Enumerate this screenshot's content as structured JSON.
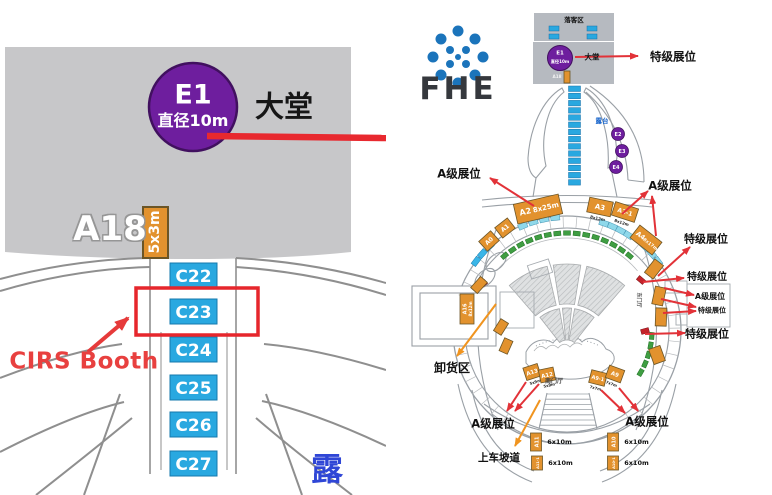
{
  "colors": {
    "lobby_gray_left": "#c7c7c9",
    "lobby_gray_right": "#b6bac0",
    "purple": "#6e1e9e",
    "purple_stroke": "#41105f",
    "booth_blue": "#29a8e0",
    "booth_orange": "#e2922e",
    "booth_green": "#3f9e42",
    "booth_cyan": "#8fd8ea",
    "booth_red": "#c4242b",
    "annot_red": "#e23238",
    "annot_orange": "#f0941f",
    "logo_blue": "#1b74bb",
    "wall_gray": "#9aa0a6"
  },
  "left": {
    "e1_label": "E1",
    "e1_sub": "直径10m",
    "hall": "大堂",
    "a18": "A18",
    "booth_5x3": "5x3m",
    "cirs": "CIRS Booth",
    "corner": "露",
    "c_booths": [
      {
        "label": "C22",
        "y": 263
      },
      {
        "label": "C23",
        "y": 299
      },
      {
        "label": "C24",
        "y": 337
      },
      {
        "label": "C25",
        "y": 375
      },
      {
        "label": "C26",
        "y": 412
      },
      {
        "label": "C27",
        "y": 451
      }
    ]
  },
  "right": {
    "logo": "FHE",
    "logo_dots": [
      {
        "x": 72,
        "y": 31,
        "r": 5.5
      },
      {
        "x": 89,
        "y": 39,
        "r": 5.5
      },
      {
        "x": 97,
        "y": 57,
        "r": 5.5
      },
      {
        "x": 89,
        "y": 75,
        "r": 5.5
      },
      {
        "x": 72,
        "y": 83,
        "r": 5.5
      },
      {
        "x": 55,
        "y": 75,
        "r": 5.5
      },
      {
        "x": 47,
        "y": 57,
        "r": 5.5
      },
      {
        "x": 55,
        "y": 39,
        "r": 5.5
      },
      {
        "x": 64,
        "y": 50,
        "r": 4
      },
      {
        "x": 80,
        "y": 50,
        "r": 4
      },
      {
        "x": 80,
        "y": 64,
        "r": 4
      },
      {
        "x": 64,
        "y": 64,
        "r": 4
      },
      {
        "x": 72,
        "y": 57,
        "r": 3
      }
    ],
    "dropoff_booths": [
      {
        "x": 163,
        "y": 26
      },
      {
        "x": 163,
        "y": 34
      },
      {
        "x": 201,
        "y": 26
      },
      {
        "x": 201,
        "y": 34
      }
    ],
    "c_column": {
      "x": 182.5,
      "y0": 86,
      "pitch": 7.2,
      "n": 14,
      "w": 12,
      "h": 5.5
    },
    "e_circles": [
      {
        "label": "E2",
        "cx": 232,
        "cy": 134
      },
      {
        "label": "E3",
        "cx": 236,
        "cy": 151
      },
      {
        "label": "E4",
        "cx": 230,
        "cy": 167
      }
    ],
    "seating": {
      "cx": 181,
      "cy": 352,
      "rows": [
        {
          "r1": 48,
          "r2": 88,
          "segs": [
            [
              -131,
              -103
            ],
            [
              -99,
              -81
            ],
            [
              -77,
              -49
            ]
          ]
        },
        {
          "r1": 12,
          "r2": 44,
          "segs": [
            [
              -128,
              -100
            ],
            [
              -96,
              -84
            ],
            [
              -80,
              -52
            ]
          ]
        }
      ]
    },
    "booth_arcs": [
      {
        "color": "#3f9e42",
        "stroke": "#1e6e22",
        "r": 97,
        "a1": -130,
        "a2": -50,
        "n": 15,
        "w": 7,
        "h": 4.5
      },
      {
        "color": "#3f9e42",
        "stroke": "#1e6e22",
        "r": 85,
        "a1": 4,
        "a2": 30,
        "n": 5,
        "w": 7,
        "h": 4.5
      },
      {
        "color": "#8fd8ea",
        "stroke": "#4596b4",
        "r": 113,
        "a1": -113,
        "a2": -96,
        "n": 4,
        "w": 9,
        "h": 5.5
      },
      {
        "color": "#8fd8ea",
        "stroke": "#4596b4",
        "r": 113,
        "a1": -71,
        "a2": -57,
        "n": 4,
        "w": 9,
        "h": 5.5
      },
      {
        "color": "#8fd8ea",
        "stroke": "#4596b4",
        "r": 114,
        "a1": -47,
        "a2": -37,
        "n": 3,
        "w": 9,
        "h": 5.5
      },
      {
        "color": "#3ab6e8",
        "stroke": "#1a7fb0",
        "r": 114,
        "a1": -143,
        "a2": -133,
        "n": 3,
        "w": 9,
        "h": 5.5
      }
    ],
    "red_booths": [
      {
        "x": 255,
        "y": 280,
        "rot": 40
      },
      {
        "x": 259,
        "y": 331,
        "rot": -15
      },
      {
        "x": 97,
        "y": 284,
        "rot": -40
      }
    ],
    "inner_rooms": [
      {
        "x": 114,
        "y": 292,
        "w": 34,
        "h": 36,
        "rot": 0
      },
      {
        "x": 143,
        "y": 262,
        "w": 22,
        "h": 14,
        "rot": -18
      },
      {
        "x": 279,
        "y": 281,
        "w": 22,
        "h": 12,
        "rot": 0
      },
      {
        "x": 301,
        "y": 284,
        "w": 43,
        "h": 43,
        "rot": 0
      },
      {
        "x": 290,
        "y": 314,
        "w": 11,
        "h": 11,
        "rot": 0
      }
    ],
    "orange_booths": [
      {
        "name": "booth-a2",
        "x": 152,
        "y": 209,
        "w": 46,
        "h": 20,
        "rot": -13,
        "labels": [
          {
            "t": "A2",
            "dx": -13,
            "dy": 2.5,
            "s": 8
          },
          {
            "t": "8x25m",
            "dx": 8,
            "dy": 2.5,
            "s": 7
          }
        ]
      },
      {
        "name": "booth-a3",
        "x": 214,
        "y": 207,
        "w": 24,
        "h": 15,
        "rot": 12,
        "labels": [
          {
            "t": "A3",
            "dx": 0,
            "dy": 2.5,
            "s": 7
          }
        ],
        "out": {
          "t": "8x12m",
          "s": 4
        }
      },
      {
        "name": "booth-a3-1",
        "x": 239,
        "y": 212,
        "w": 24,
        "h": 14,
        "rot": 18,
        "labels": [
          {
            "t": "A3-1",
            "dx": 0,
            "dy": 2,
            "s": 6
          }
        ],
        "out": {
          "t": "8x12m",
          "s": 4
        }
      },
      {
        "name": "booth-a4",
        "x": 260,
        "y": 240,
        "w": 28,
        "h": 16,
        "rot": 38,
        "labels": [
          {
            "t": "A4",
            "dx": -7,
            "dy": 2,
            "s": 6.5
          },
          {
            "t": "8x17m",
            "dx": 6,
            "dy": 2,
            "s": 4.5
          }
        ]
      },
      {
        "name": "booth-a1",
        "x": 119,
        "y": 228,
        "w": 16,
        "h": 13,
        "rot": -38,
        "labels": [
          {
            "t": "A1",
            "dx": 0,
            "dy": 2,
            "s": 6
          }
        ]
      },
      {
        "name": "booth-a0",
        "x": 103,
        "y": 241,
        "w": 16,
        "h": 13,
        "rot": -42,
        "labels": [
          {
            "t": "A0",
            "dx": 0,
            "dy": 2,
            "s": 6
          }
        ]
      },
      {
        "name": "booth-a16",
        "x": 81,
        "y": 309,
        "w": 14,
        "h": 30,
        "rot": 0,
        "labels": [
          {
            "t": "A16",
            "dx": -2.5,
            "dy": 0,
            "s": 5,
            "vert": true
          },
          {
            "t": "8x12m",
            "dx": 3.5,
            "dy": 0,
            "s": 4,
            "vert": true
          }
        ]
      },
      {
        "name": "booth-a15",
        "x": 93,
        "y": 285,
        "w": 15,
        "h": 9,
        "rot": -48,
        "labels": []
      },
      {
        "name": "booth-west-1",
        "x": 115,
        "y": 327,
        "w": 14,
        "h": 9,
        "rot": -58,
        "labels": []
      },
      {
        "name": "booth-west-2",
        "x": 120,
        "y": 346,
        "w": 14,
        "h": 9,
        "rot": -66,
        "labels": []
      },
      {
        "name": "booth-a13",
        "x": 146,
        "y": 372,
        "w": 15,
        "h": 13,
        "rot": -18,
        "labels": [
          {
            "t": "A13",
            "dx": 0,
            "dy": 2,
            "s": 5.5
          }
        ],
        "out": {
          "t": "5x9m",
          "s": 3.8
        }
      },
      {
        "name": "booth-a12",
        "x": 161,
        "y": 375,
        "w": 15,
        "h": 13,
        "rot": -12,
        "labels": [
          {
            "t": "A12",
            "dx": 0,
            "dy": 2,
            "s": 5.5
          }
        ],
        "out": {
          "t": "5x9m",
          "s": 3.8
        }
      },
      {
        "name": "booth-a9-1",
        "x": 212,
        "y": 378,
        "w": 16,
        "h": 13,
        "rot": 14,
        "labels": [
          {
            "t": "A9-1",
            "dx": 0,
            "dy": 2,
            "s": 5
          }
        ],
        "out": {
          "t": "7x7m",
          "s": 3.8
        }
      },
      {
        "name": "booth-a9",
        "x": 229,
        "y": 374,
        "w": 16,
        "h": 13,
        "rot": 20,
        "labels": [
          {
            "t": "A9",
            "dx": 0,
            "dy": 2,
            "s": 5.5
          }
        ],
        "out": {
          "t": "7x7m",
          "s": 3.8
        }
      },
      {
        "name": "booth-east-1",
        "x": 268,
        "y": 269,
        "w": 11,
        "h": 17,
        "rot": 38,
        "labels": []
      },
      {
        "name": "booth-east-2",
        "x": 273,
        "y": 296,
        "w": 11,
        "h": 18,
        "rot": 12,
        "labels": []
      },
      {
        "name": "booth-east-3",
        "x": 275,
        "y": 317,
        "w": 11,
        "h": 18,
        "rot": 2,
        "labels": []
      },
      {
        "name": "booth-east-4",
        "x": 271,
        "y": 355,
        "w": 12,
        "h": 16,
        "rot": -20,
        "labels": []
      },
      {
        "name": "booth-lobby-a18",
        "x": 181,
        "y": 77,
        "w": 6,
        "h": 12,
        "rot": 0,
        "labels": []
      },
      {
        "name": "legend-booth-a11",
        "x": 150,
        "y": 442,
        "w": 11,
        "h": 18,
        "rot": 0,
        "labels": [
          {
            "t": "A11",
            "dx": 0.5,
            "dy": 0,
            "s": 5,
            "vert": true
          }
        ],
        "right": {
          "t": "6x10m",
          "s": 6.5,
          "dx": 18
        }
      },
      {
        "name": "legend-booth-a11-1",
        "x": 151,
        "y": 463,
        "w": 11,
        "h": 14,
        "rot": 0,
        "labels": [
          {
            "t": "A11-1",
            "dx": 0.5,
            "dy": 0,
            "s": 3.6,
            "vert": true
          }
        ],
        "right": {
          "t": "6x10m",
          "s": 6.5,
          "dx": 18
        }
      },
      {
        "name": "legend-booth-a10",
        "x": 227,
        "y": 442,
        "w": 11,
        "h": 18,
        "rot": 0,
        "labels": [
          {
            "t": "A10",
            "dx": 0.5,
            "dy": 0,
            "s": 5,
            "vert": true
          }
        ],
        "right": {
          "t": "6x10m",
          "s": 6.5,
          "dx": 18
        }
      },
      {
        "name": "legend-booth-a10-1",
        "x": 227,
        "y": 463,
        "w": 11,
        "h": 14,
        "rot": 0,
        "labels": [
          {
            "t": "A10-1",
            "dx": 0.5,
            "dy": 0,
            "s": 3.6,
            "vert": true
          }
        ],
        "right": {
          "t": "6x10m",
          "s": 6.5,
          "dx": 18
        }
      }
    ],
    "labels": [
      {
        "name": "label-special-top",
        "t": "特级展位",
        "x": 287,
        "y": 57,
        "s": 11.5
      },
      {
        "name": "label-alevel-topleft",
        "t": "A级展位",
        "x": 73,
        "y": 174,
        "s": 11.5
      },
      {
        "name": "label-alevel-topright",
        "t": "A级展位",
        "x": 284,
        "y": 186,
        "s": 11.5
      },
      {
        "name": "label-special-2",
        "t": "特级展位",
        "x": 320,
        "y": 239,
        "s": 11
      },
      {
        "name": "label-special-3",
        "t": "特级展位",
        "x": 321,
        "y": 278,
        "s": 10
      },
      {
        "name": "label-alevel-right",
        "t": "A级展位",
        "x": 324,
        "y": 297,
        "s": 8
      },
      {
        "name": "label-special-4",
        "t": "特级展位",
        "x": 326,
        "y": 311,
        "s": 7
      },
      {
        "name": "label-special-5",
        "t": "特级展位",
        "x": 321,
        "y": 334,
        "s": 11
      },
      {
        "name": "label-unloading",
        "t": "卸货区",
        "x": 66,
        "y": 368,
        "s": 12
      },
      {
        "name": "label-alevel-bottomleft",
        "t": "A级展位",
        "x": 107,
        "y": 424,
        "s": 11.5
      },
      {
        "name": "label-alevel-bottomright",
        "t": "A级展位",
        "x": 261,
        "y": 422,
        "s": 11.5
      },
      {
        "name": "label-ramp",
        "t": "上车坡道",
        "x": 113,
        "y": 458,
        "s": 10.5
      },
      {
        "name": "label-south-hall",
        "t": "南门厅",
        "x": 168,
        "y": 382,
        "s": 6,
        "c": "#444",
        "w": 600
      },
      {
        "name": "label-east-hall",
        "t": "东门厅",
        "x": 252,
        "y": 300,
        "s": 5,
        "c": "#555",
        "rot": 90,
        "w": 600
      },
      {
        "name": "label-terrace",
        "t": "露台",
        "x": 216,
        "y": 121,
        "s": 6.5,
        "c": "#1a66cc"
      },
      {
        "name": "label-dropoff",
        "t": "落客区",
        "x": 188,
        "y": 20,
        "s": 6.5
      },
      {
        "name": "label-hall",
        "t": "大堂",
        "x": 206,
        "y": 57,
        "s": 7.5
      },
      {
        "name": "label-e1",
        "t": "E1",
        "x": 174,
        "y": 54,
        "s": 5.5,
        "c": "#fff"
      },
      {
        "name": "label-e1-sub",
        "t": "直径10m",
        "x": 174,
        "y": 62,
        "s": 4.2,
        "c": "#fff"
      },
      {
        "name": "label-lobby-a18",
        "t": "A18",
        "x": 171,
        "y": 77,
        "s": 4.2,
        "c": "#f2f2f2"
      }
    ],
    "arrows": [
      {
        "x1": 189,
        "y1": 57,
        "x2": 252,
        "y2": 56,
        "c": "red"
      },
      {
        "x1": 148,
        "y1": 206,
        "x2": 104,
        "y2": 178,
        "c": "red"
      },
      {
        "x1": 236,
        "y1": 214,
        "x2": 262,
        "y2": 191,
        "c": "red"
      },
      {
        "x1": 270,
        "y1": 236,
        "x2": 266,
        "y2": 196,
        "c": "red"
      },
      {
        "x1": 272,
        "y1": 276,
        "x2": 304,
        "y2": 247,
        "c": "red"
      },
      {
        "x1": 257,
        "y1": 282,
        "x2": 298,
        "y2": 278,
        "c": "red"
      },
      {
        "x1": 278,
        "y1": 288,
        "x2": 308,
        "y2": 295,
        "c": "red"
      },
      {
        "x1": 275,
        "y1": 299,
        "x2": 310,
        "y2": 307,
        "c": "red"
      },
      {
        "x1": 277,
        "y1": 313,
        "x2": 310,
        "y2": 311,
        "c": "red"
      },
      {
        "x1": 259,
        "y1": 334,
        "x2": 299,
        "y2": 333,
        "c": "red"
      },
      {
        "x1": 110,
        "y1": 304,
        "x2": 71,
        "y2": 356,
        "c": "orange"
      },
      {
        "x1": 140,
        "y1": 382,
        "x2": 121,
        "y2": 411,
        "c": "red"
      },
      {
        "x1": 153,
        "y1": 384,
        "x2": 129,
        "y2": 411,
        "c": "red"
      },
      {
        "x1": 215,
        "y1": 390,
        "x2": 239,
        "y2": 413,
        "c": "red"
      },
      {
        "x1": 233,
        "y1": 388,
        "x2": 252,
        "y2": 411,
        "c": "red"
      },
      {
        "x1": 154,
        "y1": 400,
        "x2": 129,
        "y2": 446,
        "c": "orange"
      }
    ]
  }
}
